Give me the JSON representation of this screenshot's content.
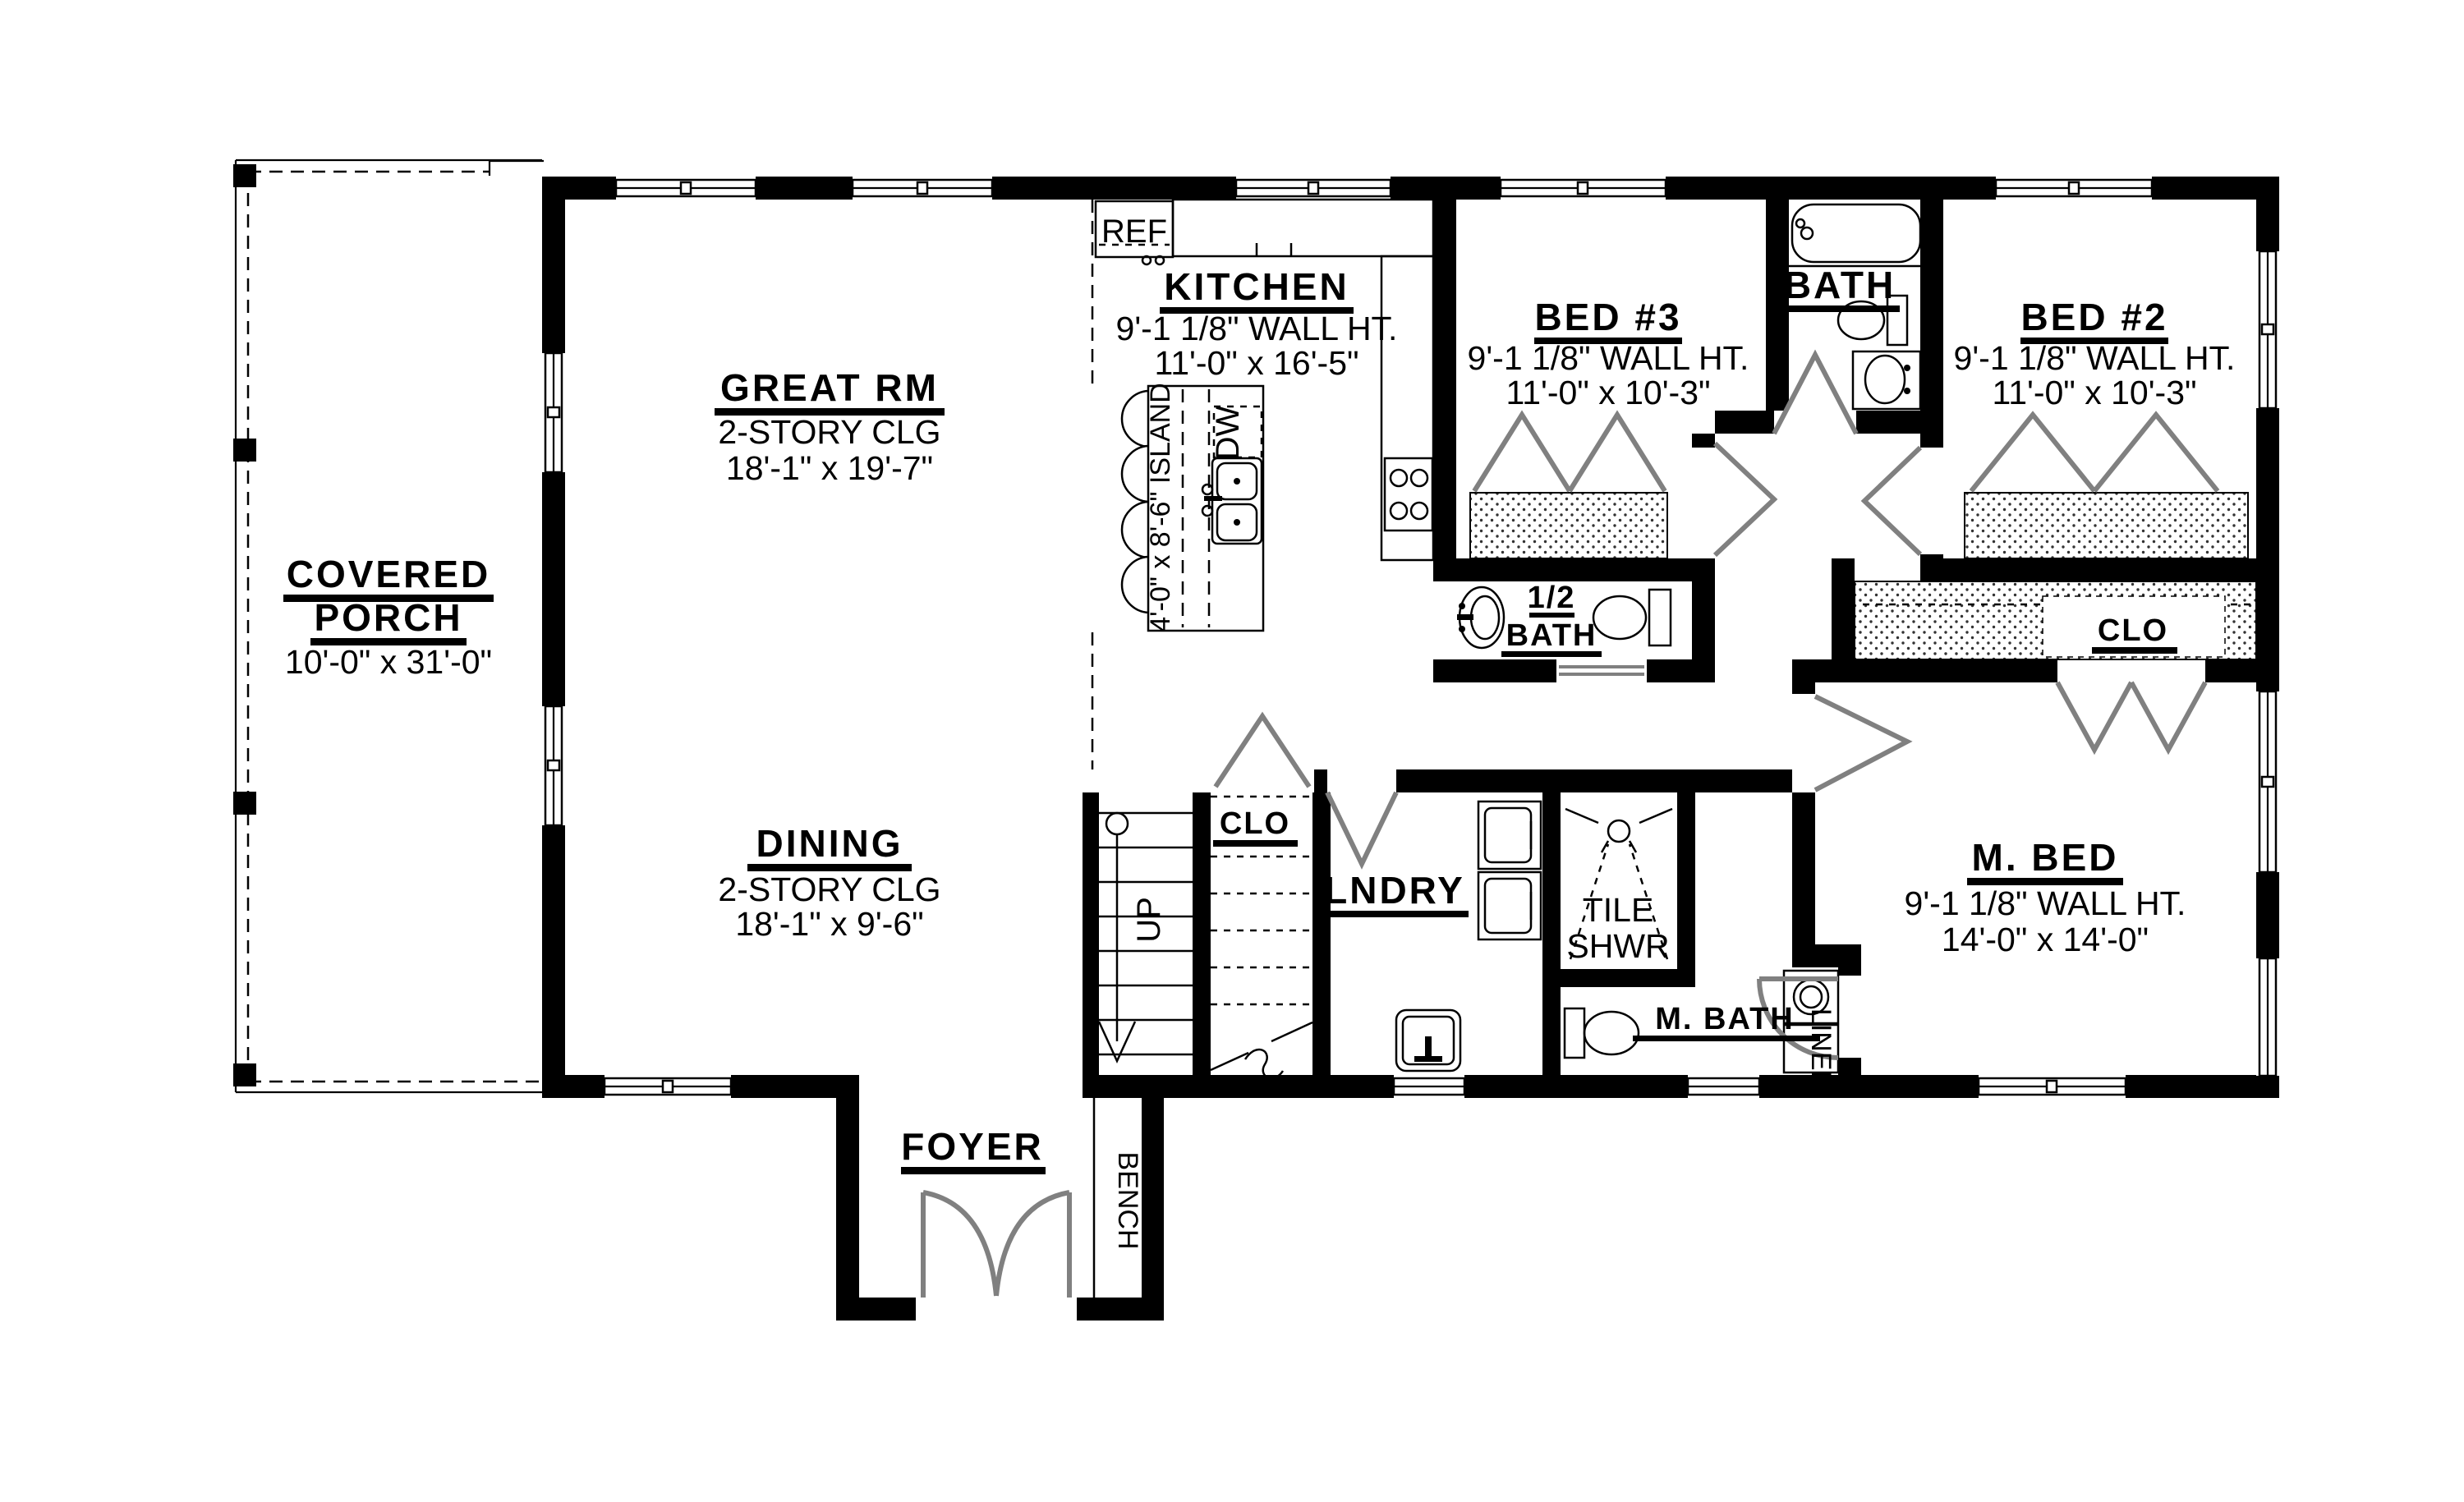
{
  "rooms": {
    "porch": {
      "line1": "COVERED",
      "line2": "PORCH",
      "dims": "10'-0\" x 31'-0\""
    },
    "great": {
      "name": "GREAT RM",
      "clg": "2-STORY CLG",
      "dims": "18'-1\" x 19'-7\""
    },
    "kitchen": {
      "name": "KITCHEN",
      "wall_ht": "9'-1 1/8\" WALL HT.",
      "dims": "11'-0\" x 16'-5\""
    },
    "dining": {
      "name": "DINING",
      "clg": "2-STORY CLG",
      "dims": "18'-1\" x 9'-6\""
    },
    "bed3": {
      "name": "BED #3",
      "wall_ht": "9'-1 1/8\" WALL HT.",
      "dims": "11'-0\" x 10'-3\""
    },
    "bath": {
      "name": "BATH"
    },
    "bed2": {
      "name": "BED #2",
      "wall_ht": "9'-1 1/8\" WALL HT.",
      "dims": "11'-0\" x 10'-3\""
    },
    "mbed": {
      "name": "M. BED",
      "wall_ht": "9'-1 1/8\" WALL HT.",
      "dims": "14'-0\" x 14'-0\""
    },
    "half_bath": {
      "line1": "1/2",
      "line2": "BATH"
    },
    "tile_shwr": {
      "line1": "TILE",
      "line2": "SHWR"
    },
    "mbath": {
      "name": "M. BATH"
    },
    "lndry": {
      "name": "LNDRY"
    },
    "foyer": {
      "name": "FOYER"
    },
    "clo_hall": {
      "name": "CLO"
    },
    "clo_master": {
      "name": "CLO"
    },
    "linen": {
      "name": "LINEN"
    },
    "bench": {
      "name": "BENCH"
    }
  },
  "labels": {
    "ref": "REF",
    "dw": "DW",
    "island": "4'-0\" x 8'-6\" ISLAND",
    "up": "UP"
  },
  "colors": {
    "wall": "#000000",
    "door": "#808080",
    "background": "#ffffff"
  }
}
